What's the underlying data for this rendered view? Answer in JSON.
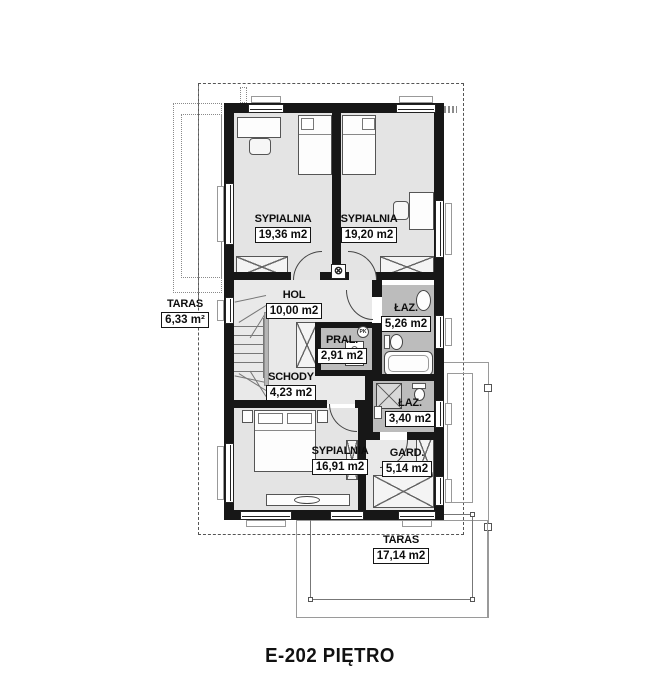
{
  "title": "E-202 PIĘTRO",
  "colors": {
    "wall": "#171717",
    "floor": "#e4e4e4",
    "floor_hall": "#e9e9e9",
    "floor_bath": "#bcbcbc",
    "background": "#ffffff"
  },
  "rooms": [
    {
      "id": "bedroom-1",
      "name": "SYPIALNIA",
      "area": "19,36 m2"
    },
    {
      "id": "bedroom-2",
      "name": "SYPIALNIA",
      "area": "19,20 m2"
    },
    {
      "id": "hall",
      "name": "HOL",
      "area": "10,00 m2"
    },
    {
      "id": "bathroom-1",
      "name": "ŁAZ.",
      "area": "5,26 m2"
    },
    {
      "id": "laundry",
      "name": "PRAL.",
      "area": "2,91 m2"
    },
    {
      "id": "stairs",
      "name": "SCHODY",
      "area": "4,23 m2"
    },
    {
      "id": "bathroom-2",
      "name": "ŁAZ.",
      "area": "3,40 m2"
    },
    {
      "id": "bedroom-3",
      "name": "SYPIALNIA",
      "area": "16,91 m2"
    },
    {
      "id": "wardrobe-room",
      "name": "GARD.",
      "area": "5,14 m2"
    },
    {
      "id": "terrace-left",
      "name": "TARAS",
      "area": "6,33 m²"
    },
    {
      "id": "terrace-bottom",
      "name": "TARAS",
      "area": "17,14 m2"
    }
  ],
  "symbols": {
    "vent": "⊗",
    "pk": "PK"
  }
}
